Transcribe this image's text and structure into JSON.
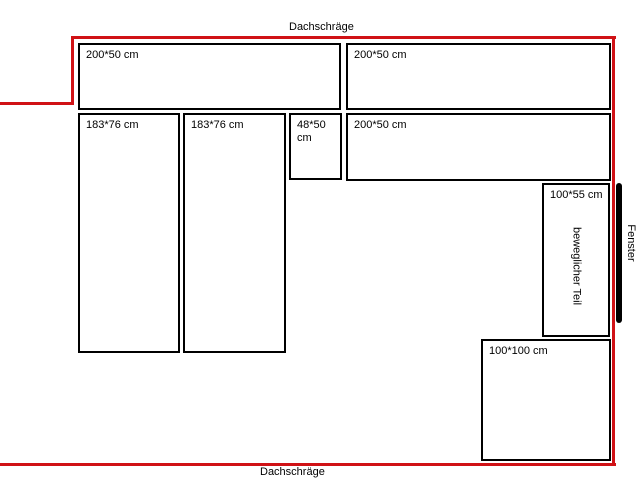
{
  "diagram": {
    "roof_label_top": "Dachschräge",
    "roof_label_bottom": "Dachschräge",
    "window_label": "Fenster",
    "colors": {
      "wall_outline": "#d01216",
      "box_border": "#000000",
      "background": "#ffffff"
    },
    "boxes": [
      {
        "label": "200*50 cm"
      },
      {
        "label": "200*50 cm"
      },
      {
        "label": "183*76 cm"
      },
      {
        "label": "183*76 cm"
      },
      {
        "label": "48*50 cm"
      },
      {
        "label": "200*50 cm"
      },
      {
        "label": "100*55 cm",
        "sublabel": "beweglicher Teil"
      },
      {
        "label": "100*100 cm"
      }
    ]
  }
}
